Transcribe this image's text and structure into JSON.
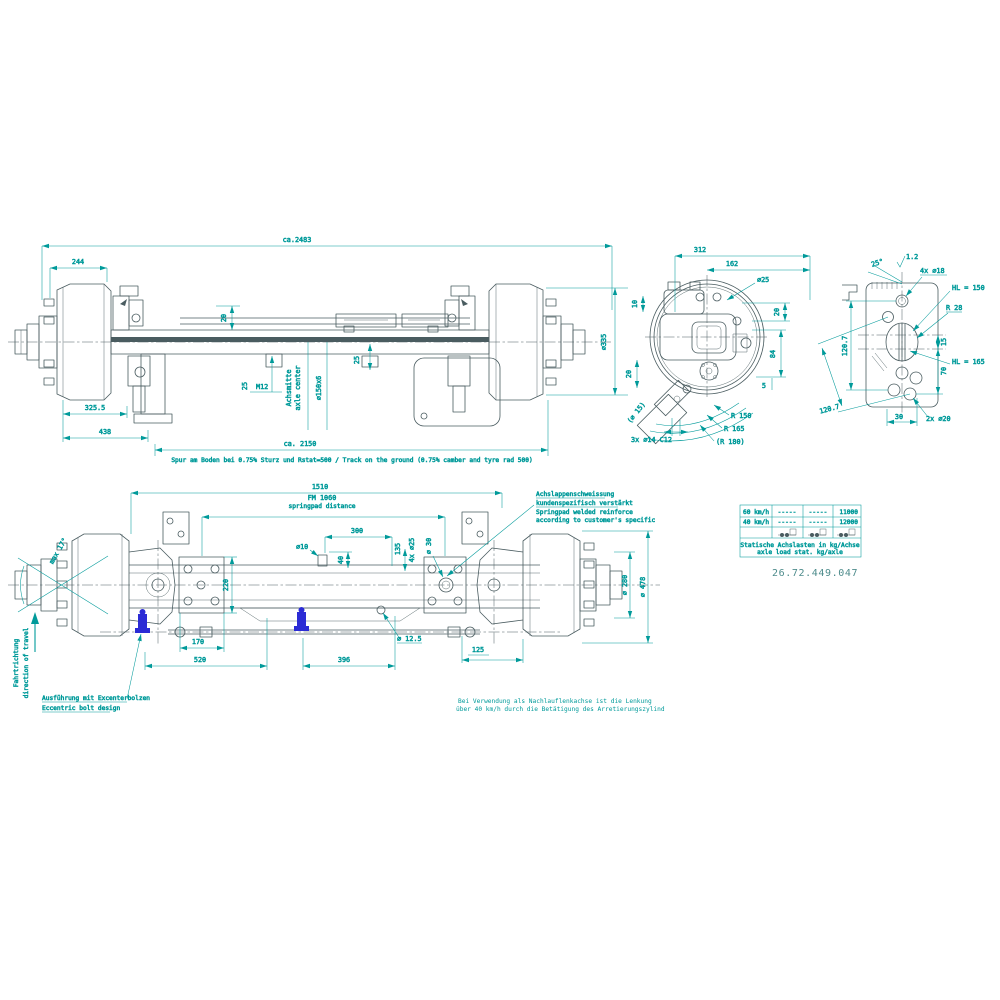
{
  "colors": {
    "dimension": "#009a9a",
    "geometry": "#4a5c60",
    "highlight": "#2b2bd5"
  },
  "side_view": {
    "overall_length": "ca.2483",
    "hub_width": "244",
    "rod_offset": "20",
    "clamp_offset": "25",
    "thread": "M12",
    "center_label_de": "Achsmitte",
    "center_label_en": "axle center",
    "tube_size": "⌀150x6",
    "clamp_offset2": "25",
    "drum_diameter": "⌀335",
    "face_to_spring": "325.5",
    "face_to_bracket": "438",
    "track_width": "ca. 2150",
    "track_note": "Spur am Boden bei 0.75% Sturz und Rstat=500 / Track on the ground (0.75% camber and tyre rad 500)"
  },
  "end_view": {
    "width_312": "312",
    "width_162": "162",
    "hole_25": "⌀25",
    "offset_10": "10",
    "offset_20_right": "20",
    "offset_84": "84",
    "offset_5": "5",
    "offset_20_left": "20",
    "chamber_hole": "(⌀ 15)",
    "mount_holes": "3x ⌀14 C12",
    "radius_150": "R 150",
    "radius_165": "R 165",
    "radius_180": "(R 180)"
  },
  "pad_view": {
    "surface_finish": "1.2",
    "chamfer_angle": "25°",
    "holes_18": "4x ⌀18",
    "hl_150": "HL = 150",
    "radius_28": "R 28",
    "offset_15": "15",
    "offset_70": "70",
    "hl_165": "HL = 165",
    "height_1207": "120.7",
    "diag_1207": "120.7",
    "width_30": "30",
    "holes_20": "2x ⌀20"
  },
  "plan_view": {
    "width_1510": "1510",
    "fm_label": "FM 1060",
    "fm_label_en": "springpad distance",
    "width_300": "300",
    "hole_10": "⌀10",
    "offset_40": "40",
    "offset_135": "135",
    "holes_25": "4x ⌀25",
    "hole_30": "⌀ 30",
    "pad_width_220": "220",
    "width_170": "170",
    "width_520": "520",
    "width_396": "396",
    "hole_125": "⌀ 12.5",
    "width_125": "125",
    "hub_dia_280": "⌀ 280",
    "drum_dia_478": "⌀ 478",
    "steer_angle": "max 17°",
    "direction_de": "Fahrtrichtung",
    "direction_en": "direction of travel",
    "eccentric_de": "Ausführung mit Excenterbolzen",
    "eccentric_en": "Eccentric bolt design",
    "weld_note_de1": "Achslappenschweissung",
    "weld_note_de2": "kundenspezifisch verstärkt",
    "weld_note_en1": "Springpad welded reinforce",
    "weld_note_en2": "according to customer's specific"
  },
  "load_table": {
    "rows": [
      {
        "speed": "60 km/h",
        "col2": "-----",
        "col3": "-----",
        "load": "11000"
      },
      {
        "speed": "40 km/h",
        "col2": "-----",
        "col3": "-----",
        "load": "12000"
      }
    ],
    "caption_de": "Statische Achslasten in kg/Achse",
    "caption_en": "axle load stat. kg/axle",
    "part_number": "26.72.449.047"
  },
  "notes": {
    "steering_line1": "Bei Verwendung als Nachlauflenkachse ist die Lenkung",
    "steering_line2": "über 40 km/h durch die Betätigung des Arretierungszylind"
  }
}
